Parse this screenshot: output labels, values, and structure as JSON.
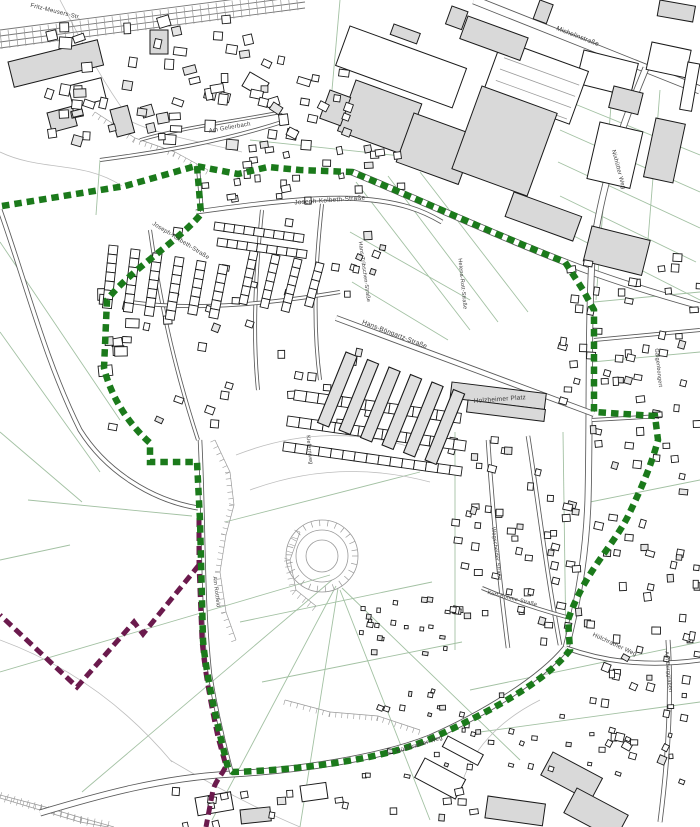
{
  "map": {
    "kind": "cadastral-zoning-plan",
    "colors": {
      "background": "#ffffff",
      "boundary_primary_green": "#1b7a1b",
      "boundary_secondary_purple": "#6b1a4d",
      "building_gray_fill": "#d9d9d9",
      "building_outline": "#1a1a1a",
      "parcel_line_green": "#a3c1a3",
      "road_casing": "#5a5a5a",
      "contour_gray": "#bdbdbd",
      "label_gray": "#3a3a3a"
    },
    "features": [
      "railway-tracks",
      "industrial-buildings",
      "residential-row-houses",
      "apartment-slabs",
      "parking-lot",
      "allotment-gardens",
      "plan-boundary-green-dashed",
      "secondary-boundary-purple-dashed",
      "earth-mound",
      "parcel-lines"
    ],
    "street_labels": [
      {
        "text": "Fritz-Meusers-Str.",
        "x": 55,
        "y": 13,
        "rot": 14,
        "size": 6
      },
      {
        "text": "Am Gelierbach",
        "x": 230,
        "y": 129,
        "rot": -10,
        "size": 6
      },
      {
        "text": "Michelinstraße",
        "x": 577,
        "y": 38,
        "rot": 21,
        "size": 6.5
      },
      {
        "text": "Nixhütter Weg",
        "x": 617,
        "y": 170,
        "rot": 75,
        "size": 6
      },
      {
        "text": "Joseph-Kolbeth-Straße",
        "x": 330,
        "y": 202,
        "rot": -4,
        "size": 6.5
      },
      {
        "text": "Joseph-Kolbeth-Straße",
        "x": 180,
        "y": 242,
        "rot": 32,
        "size": 6
      },
      {
        "text": "Hans-Tribschen-Straße",
        "x": 363,
        "y": 272,
        "rot": 82,
        "size": 5.5
      },
      {
        "text": "Helena-Rott-Straße",
        "x": 461,
        "y": 284,
        "rot": 84,
        "size": 5.5
      },
      {
        "text": "Hans-Böngartz-Straße",
        "x": 394,
        "y": 336,
        "rot": 21,
        "size": 6.5
      },
      {
        "text": "Holzheimer Platz",
        "x": 500,
        "y": 401,
        "rot": -4,
        "size": 6.5
      },
      {
        "text": "Kiefernweg",
        "x": 308,
        "y": 450,
        "rot": 84,
        "size": 5.5
      },
      {
        "text": "Am Rottfeld",
        "x": 215,
        "y": 592,
        "rot": 83,
        "size": 5.5
      },
      {
        "text": "Wegscheider Straße",
        "x": 495,
        "y": 554,
        "rot": 83,
        "size": 5.5
      },
      {
        "text": "Kurt-Böhme-Straße",
        "x": 512,
        "y": 600,
        "rot": 14,
        "size": 5.5
      },
      {
        "text": "Hülchrather Weg",
        "x": 614,
        "y": 646,
        "rot": 25,
        "size": 6
      },
      {
        "text": "Hülchrather Weg",
        "x": 420,
        "y": 746,
        "rot": -17,
        "size": 6
      },
      {
        "text": "Am Burggraben",
        "x": 667,
        "y": 672,
        "rot": 84,
        "size": 5.5
      },
      {
        "text": "Galgenbongert",
        "x": 657,
        "y": 368,
        "rot": 84,
        "size": 5.5
      }
    ]
  }
}
